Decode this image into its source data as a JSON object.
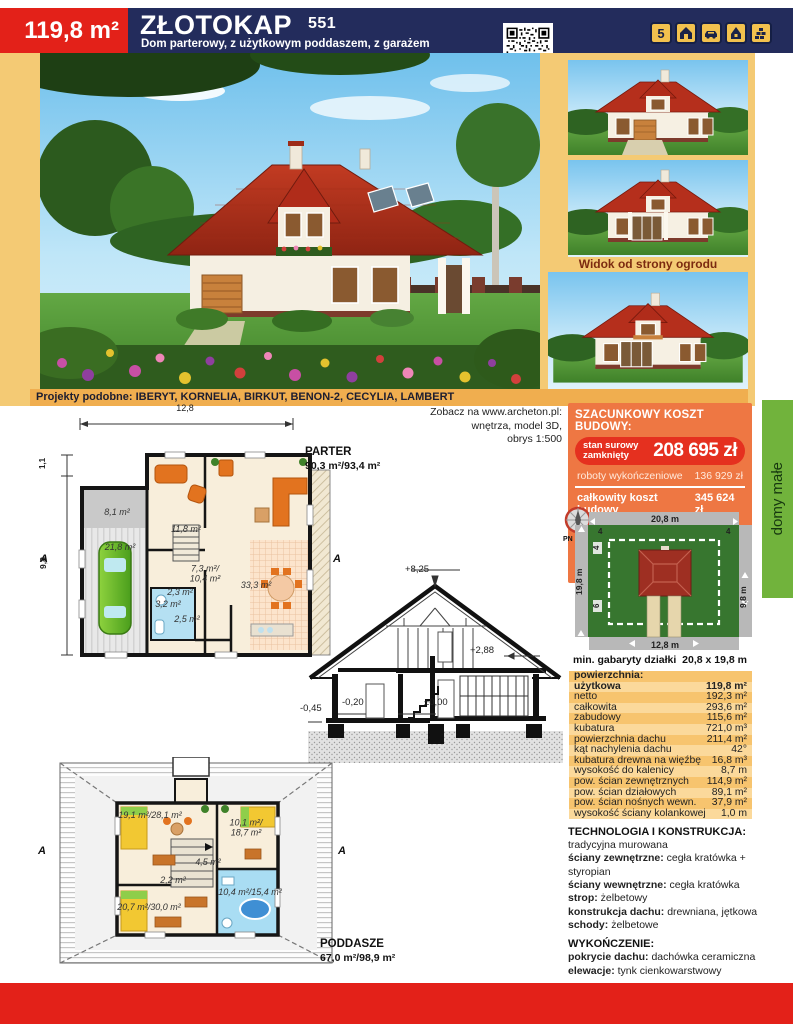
{
  "header": {
    "area_badge": "119,8 m²",
    "title": "ZŁOTOKAP",
    "project_number": "551",
    "subtitle": "Dom parterowy, z użytkowym poddaszem, z garażem",
    "badge_count": "5"
  },
  "photos": {
    "garden_view_caption": "Widok od strony ogrodu"
  },
  "similar_projects": {
    "label": "Projekty podobne:",
    "names": "IBERYT, KORNELIA, BIRKUT, BENON-2, CECYLIA, LAMBERT"
  },
  "web_note": {
    "line1": "Zobacz na www.archeton.pl:",
    "line2": "wnętrza, model 3D,",
    "line3": "obrys 1:500"
  },
  "costs": {
    "title": "SZACUNKOWY KOSZT BUDOWY:",
    "shell_label_line1": "stan surowy",
    "shell_label_line2": "zamknięty",
    "shell_value": "208 695 zł",
    "finishing_label": "roboty wykończeniowe",
    "finishing_value": "136 929 zł",
    "total_label": "całkowity koszt budowy",
    "total_value": "345 624 zł",
    "installations_label": "szacunkowy koszt instalacji:",
    "installations_value": "50 115 zł",
    "economy_label": "systemem gospodarczym:",
    "economy_value": "242 000 zł"
  },
  "plot": {
    "compass_label": "PN",
    "dim_top": "20,8 m",
    "dim_left": "19,8 m",
    "dim_right": "9,8 m",
    "dim_bottom": "12,8 m",
    "offset_top_left": "4",
    "offset_top_right": "4",
    "offset_left_top": "4",
    "offset_left_bottom": "6",
    "min_label": "min. gabaryty działki",
    "min_value": "20,8 x 19,8 m"
  },
  "areas": {
    "rows": [
      {
        "label": "powierzchnia:",
        "value": "",
        "bold": true
      },
      {
        "label": "użytkowa",
        "value": "119,8 m²",
        "bold": true
      },
      {
        "label": "netto",
        "value": "192,3 m²"
      },
      {
        "label": "całkowita",
        "value": "293,6 m²"
      },
      {
        "label": "zabudowy",
        "value": "115,6 m²"
      },
      {
        "label": "kubatura",
        "value": "721,0 m³"
      },
      {
        "label": "powierzchnia dachu",
        "value": "211,4 m²"
      },
      {
        "label": "kąt nachylenia dachu",
        "value": "42°"
      },
      {
        "label": "kubatura drewna na więźbę",
        "value": "16,8 m³"
      },
      {
        "label": "wysokość do kalenicy",
        "value": "8,7 m"
      },
      {
        "label": "pow. ścian zewnętrznych",
        "value": "114,9 m²"
      },
      {
        "label": "pow. ścian działowych",
        "value": "89,1 m²"
      },
      {
        "label": "pow. ścian nośnych wewn.",
        "value": "37,9 m²"
      },
      {
        "label": "wysokość ściany kolankowej",
        "value": "1,0 m"
      }
    ]
  },
  "construction": {
    "sections": [
      {
        "title": "TECHNOLOGIA I KONSTRUKCJA:",
        "items": [
          {
            "text": "tradycyjna murowana"
          },
          {
            "label": "ściany zewnętrzne:",
            "text": "cegła kratówka + styropian"
          },
          {
            "label": "ściany wewnętrzne:",
            "text": "cegła kratówka"
          },
          {
            "label": "strop:",
            "text": "żelbetowy"
          },
          {
            "label": "konstrukcja dachu:",
            "text": "drewniana, jętkowa"
          },
          {
            "label": "schody:",
            "text": "żelbetowe"
          }
        ]
      },
      {
        "title": "WYKOŃCZENIE:",
        "items": [
          {
            "label": "pokrycie dachu:",
            "text": "dachówka ceramiczna"
          },
          {
            "label": "elewacje:",
            "text": "tynk cienkowarstwowy"
          }
        ]
      },
      {
        "title": "SPOSÓB OGRZEWANIA:",
        "items": [
          {
            "text": "kocioł na gaz"
          }
        ]
      }
    ]
  },
  "floor_plans": {
    "parter": {
      "name": "PARTER",
      "area": "90,3 m²/93,4 m²",
      "dim_width": "12,8",
      "dim_height": "9,8",
      "dim_small": "1,1",
      "section_mark": "A",
      "rooms": [
        "8,1 m²",
        "21,8 m²",
        "11,8 m²",
        "7,3 m²/\n10,4 m²",
        "2,3 m²",
        "3,2 m²",
        "2,5 m²",
        "33,3 m²"
      ]
    },
    "poddasze": {
      "name": "PODDASZE",
      "area": "67,0 m²/98,9 m²",
      "section_mark": "A",
      "rooms": [
        "19,1 m²/28,1 m²",
        "10,1 m²/\n18,7 m²",
        "4,5 m²",
        "2,2 m²",
        "10,4 m²/15,4 m²",
        "20,7 m²/30,0 m²"
      ]
    },
    "cross_section": {
      "levels": [
        "+8,25",
        "+2,88",
        "±0,00",
        "-0,20",
        "-0,45"
      ]
    }
  },
  "side_tab": {
    "label": "domy małe"
  },
  "colors": {
    "navy": "#232c5c",
    "red": "#e32119",
    "page_yellow": "#f4ca74",
    "bar_orange": "#f0ae4f",
    "cost_orange": "#ee7743",
    "cost_red": "#e5301f",
    "green_tab": "#71b33c",
    "plot_green": "#37762f"
  }
}
